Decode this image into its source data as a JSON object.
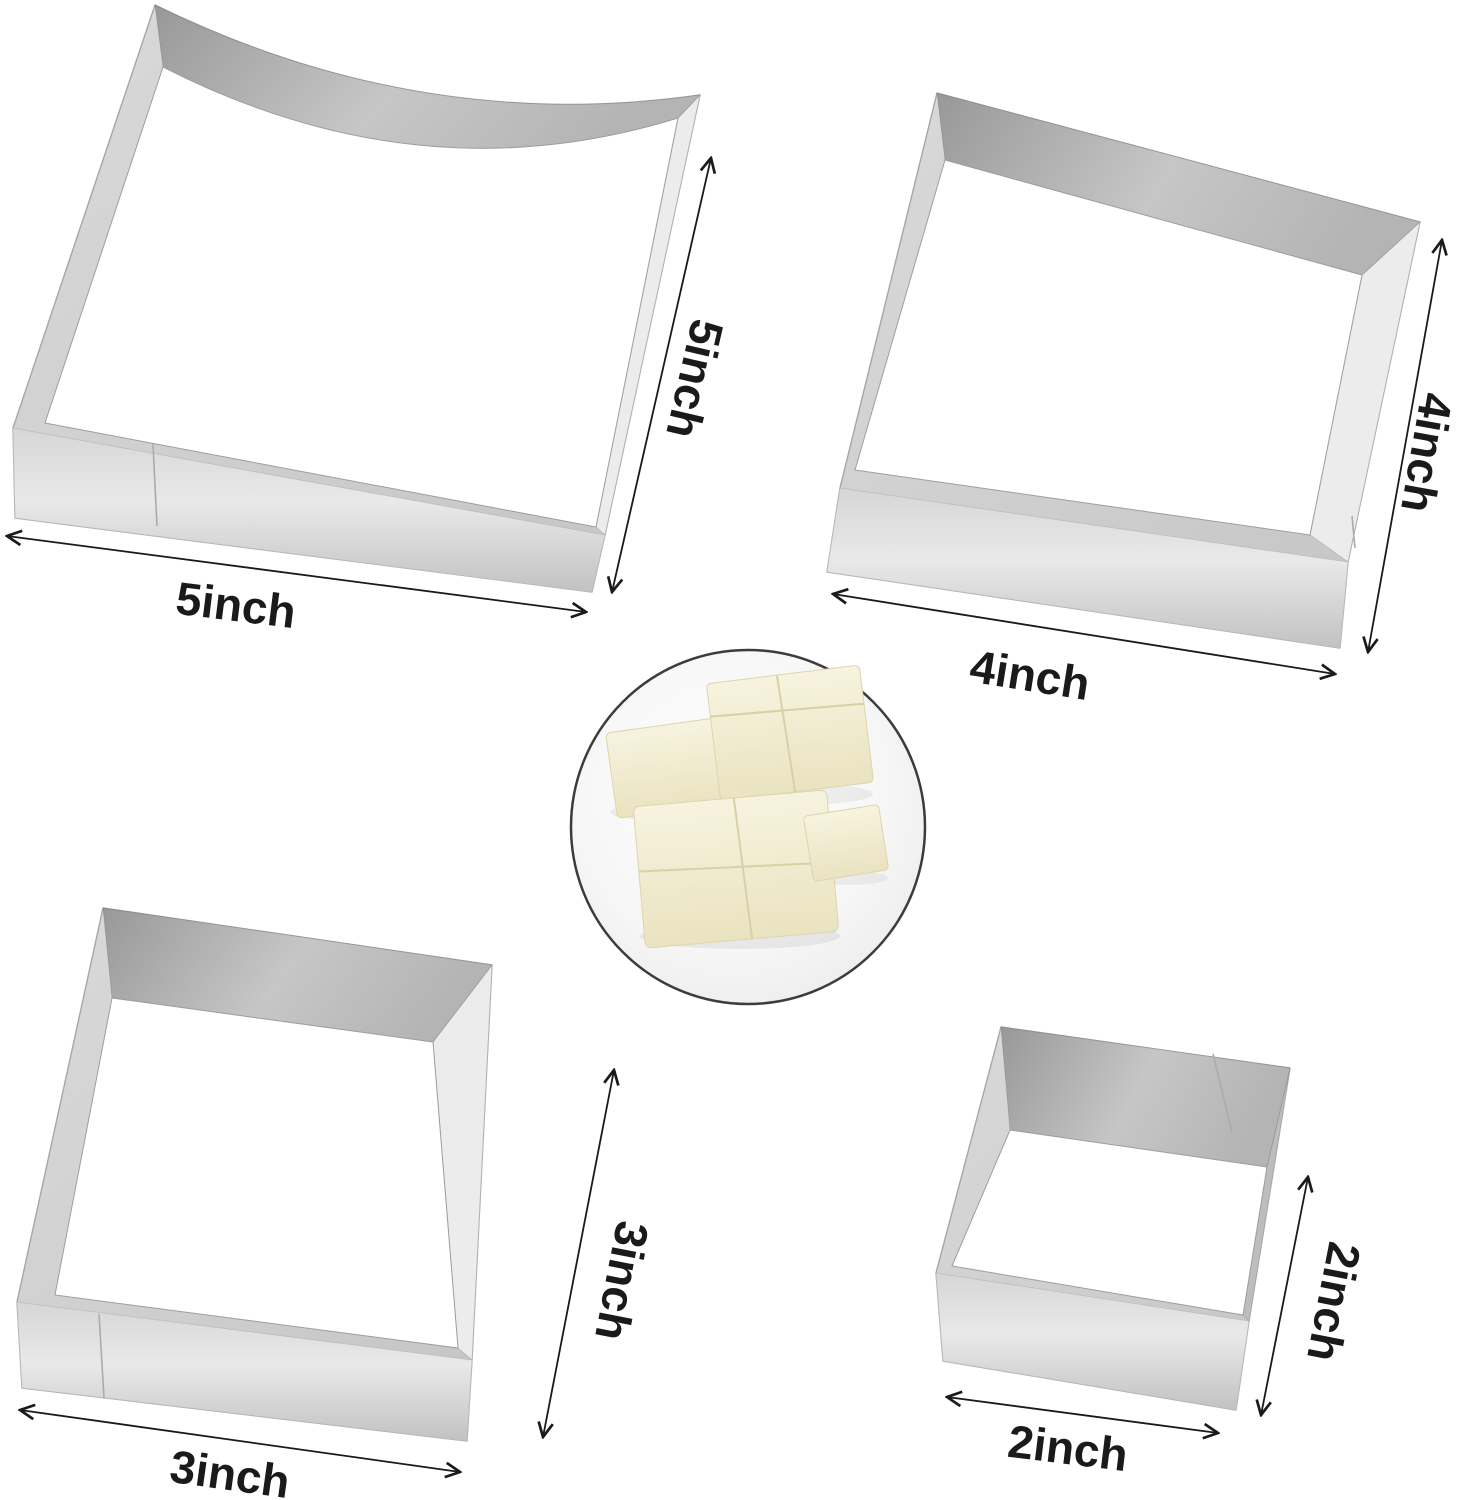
{
  "cutters": [
    {
      "id": "5-inch-square-cutter",
      "bottom_label": "5inch",
      "side_label": "5inch"
    },
    {
      "id": "4-inch-square-cutter",
      "bottom_label": "4inch",
      "side_label": "4inch"
    },
    {
      "id": "3-inch-square-cutter",
      "bottom_label": "3inch",
      "side_label": "3inch"
    },
    {
      "id": "2-inch-square-cutter",
      "bottom_label": "2inch",
      "side_label": "2inch"
    }
  ],
  "inset": {
    "content": "bread slices cut into squares on a plate"
  },
  "colors": {
    "background": "#ffffff",
    "annotation": "#1a1a1a",
    "metal_base": "#cfcfcf",
    "metal_dark": "#9a9a9a",
    "metal_light": "#ececec",
    "plate": "#f1f1f1",
    "circle_border": "#3c3c3c",
    "bread": "#f2edd4"
  }
}
